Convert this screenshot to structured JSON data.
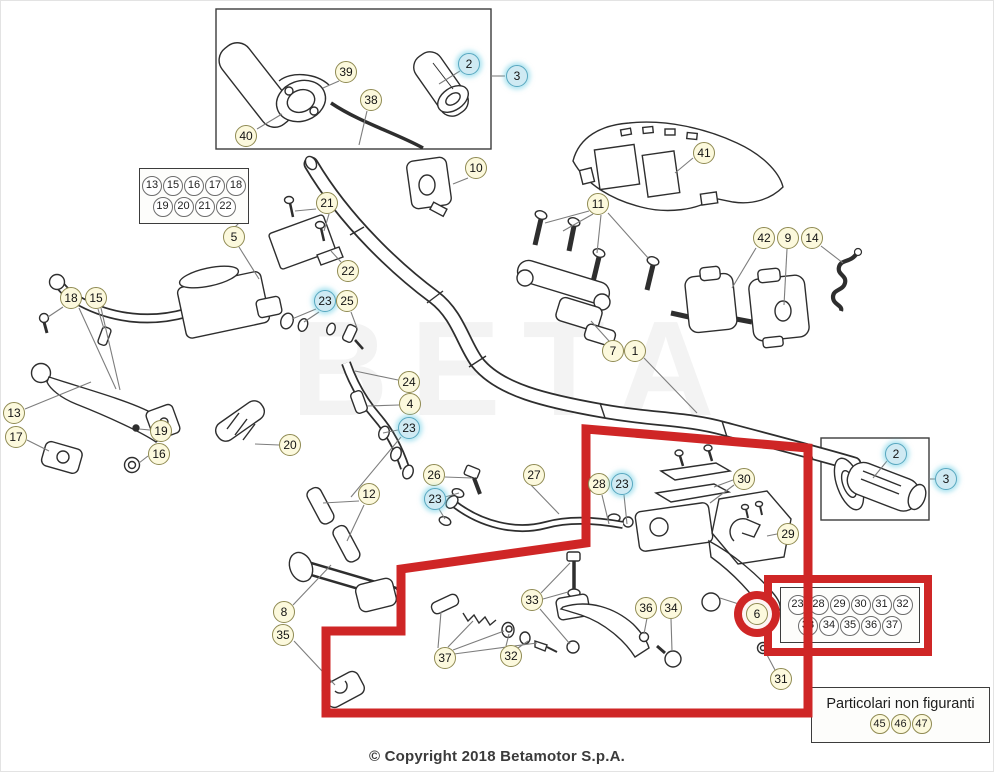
{
  "watermark": "BETA",
  "footer": {
    "copyright": "© Copyright 2018 Betamotor S.p.A."
  },
  "colors": {
    "highlight_red": "#cf2626",
    "callout_yellow": "#fcf9dd",
    "callout_cyan": "#cfeaf3",
    "line_gray": "#7d7d7d"
  },
  "boxes": {
    "top_left_grid": {
      "rows": [
        [
          "13",
          "15",
          "16",
          "17",
          "18"
        ],
        [
          "19",
          "20",
          "21",
          "22"
        ]
      ]
    },
    "red_grid": {
      "rows": [
        [
          "23",
          "28",
          "29",
          "30",
          "31",
          "32"
        ],
        [
          "33",
          "34",
          "35",
          "36",
          "37"
        ]
      ]
    },
    "not_shown": {
      "label": "Particolari non figuranti",
      "items": [
        "45",
        "46",
        "47"
      ]
    }
  },
  "callouts": [
    {
      "label": "39",
      "x": 345,
      "y": 71,
      "c": "yellow"
    },
    {
      "label": "38",
      "x": 370,
      "y": 99,
      "c": "yellow"
    },
    {
      "label": "40",
      "x": 245,
      "y": 135,
      "c": "yellow"
    },
    {
      "label": "2",
      "x": 468,
      "y": 63,
      "c": "cyan"
    },
    {
      "label": "3",
      "x": 516,
      "y": 75,
      "c": "cyan"
    },
    {
      "label": "10",
      "x": 475,
      "y": 167,
      "c": "yellow"
    },
    {
      "label": "41",
      "x": 703,
      "y": 152,
      "c": "yellow"
    },
    {
      "label": "11",
      "x": 597,
      "y": 203,
      "c": "yellow"
    },
    {
      "label": "5",
      "x": 233,
      "y": 236,
      "c": "yellow"
    },
    {
      "label": "21",
      "x": 326,
      "y": 202,
      "c": "yellow"
    },
    {
      "label": "22",
      "x": 347,
      "y": 270,
      "c": "yellow"
    },
    {
      "label": "23",
      "x": 324,
      "y": 300,
      "c": "cyan"
    },
    {
      "label": "25",
      "x": 346,
      "y": 300,
      "c": "yellow"
    },
    {
      "label": "42",
      "x": 763,
      "y": 237,
      "c": "yellow"
    },
    {
      "label": "9",
      "x": 787,
      "y": 237,
      "c": "yellow"
    },
    {
      "label": "14",
      "x": 811,
      "y": 237,
      "c": "yellow"
    },
    {
      "label": "18",
      "x": 70,
      "y": 297,
      "c": "yellow"
    },
    {
      "label": "15",
      "x": 95,
      "y": 297,
      "c": "yellow"
    },
    {
      "label": "7",
      "x": 612,
      "y": 350,
      "c": "yellow"
    },
    {
      "label": "1",
      "x": 634,
      "y": 350,
      "c": "yellow"
    },
    {
      "label": "24",
      "x": 408,
      "y": 381,
      "c": "yellow"
    },
    {
      "label": "4",
      "x": 409,
      "y": 403,
      "c": "yellow"
    },
    {
      "label": "23",
      "x": 408,
      "y": 427,
      "c": "cyan"
    },
    {
      "label": "13",
      "x": 13,
      "y": 412,
      "c": "yellow"
    },
    {
      "label": "17",
      "x": 15,
      "y": 436,
      "c": "yellow"
    },
    {
      "label": "19",
      "x": 160,
      "y": 430,
      "c": "yellow"
    },
    {
      "label": "16",
      "x": 158,
      "y": 453,
      "c": "yellow"
    },
    {
      "label": "20",
      "x": 289,
      "y": 444,
      "c": "yellow"
    },
    {
      "label": "26",
      "x": 433,
      "y": 474,
      "c": "yellow"
    },
    {
      "label": "23",
      "x": 434,
      "y": 498,
      "c": "cyan"
    },
    {
      "label": "27",
      "x": 533,
      "y": 474,
      "c": "yellow"
    },
    {
      "label": "12",
      "x": 368,
      "y": 493,
      "c": "yellow"
    },
    {
      "label": "28",
      "x": 598,
      "y": 483,
      "c": "yellow"
    },
    {
      "label": "23",
      "x": 621,
      "y": 483,
      "c": "cyan"
    },
    {
      "label": "30",
      "x": 743,
      "y": 478,
      "c": "yellow"
    },
    {
      "label": "29",
      "x": 787,
      "y": 533,
      "c": "yellow"
    },
    {
      "label": "2",
      "x": 895,
      "y": 453,
      "c": "cyan"
    },
    {
      "label": "3",
      "x": 945,
      "y": 478,
      "c": "cyan"
    },
    {
      "label": "8",
      "x": 283,
      "y": 611,
      "c": "yellow"
    },
    {
      "label": "35",
      "x": 282,
      "y": 634,
      "c": "yellow"
    },
    {
      "label": "33",
      "x": 531,
      "y": 599,
      "c": "yellow"
    },
    {
      "label": "36",
      "x": 645,
      "y": 607,
      "c": "yellow"
    },
    {
      "label": "34",
      "x": 670,
      "y": 607,
      "c": "yellow"
    },
    {
      "label": "37",
      "x": 444,
      "y": 657,
      "c": "yellow"
    },
    {
      "label": "32",
      "x": 510,
      "y": 655,
      "c": "yellow"
    },
    {
      "label": "6",
      "x": 756,
      "y": 613,
      "c": "yellow",
      "ring": true
    },
    {
      "label": "31",
      "x": 780,
      "y": 678,
      "c": "yellow"
    }
  ]
}
